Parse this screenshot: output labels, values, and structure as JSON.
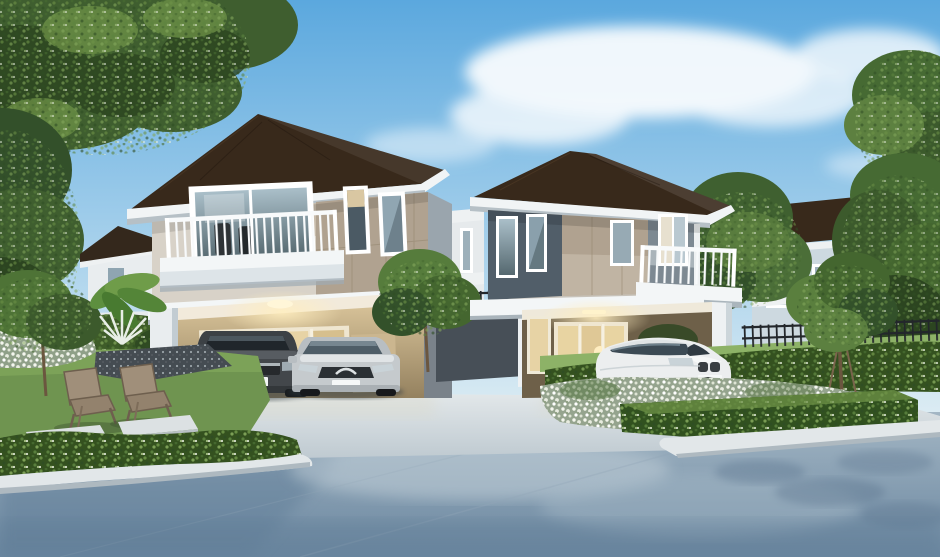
{
  "meta": {
    "title": "Architectural rendering of two modern two-storey suburban houses",
    "type": "3d-exterior-rendering",
    "time_of_day": "daytime, clear blue sky with scattered clouds"
  },
  "scene": {
    "sky": {
      "description": "blue sky gradient with soft white clouds"
    },
    "houses": {
      "left_house": {
        "label": "left two-storey house",
        "roof": "dark brown hip roof with white fascia",
        "upper_floor": "white and tan panel walls, balcony with white railing, sliding window with office chairs visible inside, two narrow windows",
        "ground_floor": "open carport with warm ceiling light, beige interior wall, glass sliding doors and side door"
      },
      "right_house": {
        "label": "right two-storey house",
        "roof": "dark brown hip roof with white fascia",
        "upper_floor": "slate gray corner wall with two windows, tan panel wall with window, white balcony with sliding glass door",
        "ground_floor": "carport with lit interior, glass doors showing sofa and floor lamp, white pillars"
      },
      "background_houses": [
        {
          "label": "small white house with dark roof behind left trees"
        },
        {
          "label": "white house with windows between the two main houses"
        },
        {
          "label": "blue-gray two-storey house with brown roof and white balcony at right"
        }
      ]
    },
    "cars": [
      {
        "label": "dark gray sedan with H emblem, blank white license plate",
        "location": "left carport"
      },
      {
        "label": "silver sedan with winged chrome grille emblem, blank white license plate",
        "location": "left carport"
      },
      {
        "label": "white SUV crossover with twin-kidney grille, blank white license plate",
        "location": "right driveway"
      }
    ],
    "garden": {
      "left": "lawn with two wooden lounge chairs, stepping stones, dark pebble bed, white flower bush, banana palm and white fan palm, low trimmed hedge with stone curb",
      "middle": "gray garden wall with black metal fence, white pillar, small tree and hedge between houses",
      "right": "white flower beds, trimmed box hedge with curb, young staked tree, long hedge with black metal fence"
    },
    "road": {
      "description": "blue-gray street in foreground, light concrete driveway apron with white curbs, dappled tree shadows"
    }
  },
  "colors": {
    "sky_top": "#5ba8de",
    "sky_mid": "#a9d2ec",
    "sky_horizon": "#eaf3f5",
    "cloud": "#ffffff",
    "roof_dark": "#38291b",
    "roof_light": "#55402a",
    "fascia": "#f1f4f5",
    "wall_white": "#ebeff1",
    "wall_shade": "#cfd8dd",
    "panel_tan": "#b0a290",
    "panel_tan_light": "#c8bcab",
    "slate": "#515e69",
    "slate_light": "#7d8992",
    "slab": "#f3f6f7",
    "glass_sky": "#90a6b2",
    "glass_dark": "#41505a",
    "glass_warm": "#e7d3a5",
    "carport_wall": "#c3ad88",
    "glow": "#ffe9b5",
    "hedge_dark": "#34511f",
    "hedge_mid": "#4b6e2f",
    "grass": "#6f9450",
    "grass_light": "#8db267",
    "foliage": "#44662f",
    "foliage_dark": "#2c4520",
    "foliage_light": "#6e9247",
    "flowerbed": "#95a48e",
    "trunk": "#6b563f",
    "road": "#7e94a8",
    "road_dark": "#64809a",
    "road_light": "#bccad4",
    "drive": "#d7dee2",
    "curb": "#e2e7e9",
    "fence": "#23272b",
    "wall_gray": "#474f57",
    "pillar": "#eef1f3",
    "car_dark": "#43474b",
    "car_silver": "#c5cacd",
    "car_white": "#eceeef",
    "chair": "#95846f",
    "stone": "#dce1e3",
    "bg_house_wall": "#cdd9e0",
    "bg_house_white": "#e9edef"
  }
}
